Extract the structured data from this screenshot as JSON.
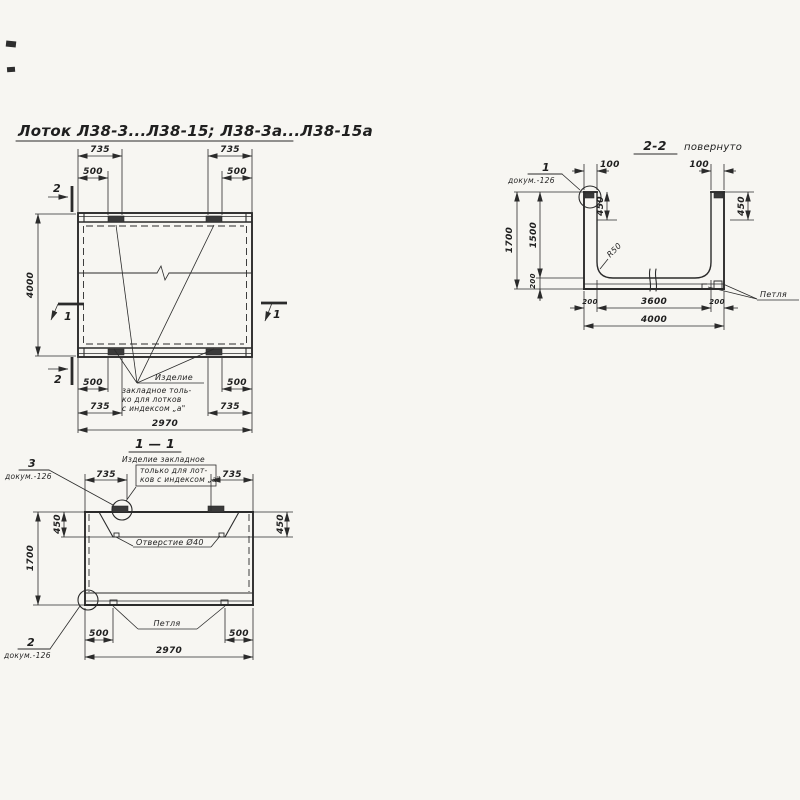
{
  "colors": {
    "ink": "#2b2b2b",
    "paper": "#f7f6f2"
  },
  "title": {
    "text": "Лоток Л38-3...Л38-15; Л38-3а...Л38-15а"
  },
  "plan": {
    "marks": {
      "sec1": "1",
      "sec2": "2"
    },
    "dims": {
      "d735": "735",
      "d500": "500",
      "d4000": "4000",
      "d2970": "2970"
    },
    "note": {
      "line1": "Изделие",
      "line2": "закладное толь-",
      "line3": "ко для лотков",
      "line4": "с индексом „а\""
    }
  },
  "section_1_1": {
    "title": "1 — 1",
    "note": {
      "line1": "Изделие закладное",
      "line2": "только для лот-",
      "line3": "ков с индексом „а\""
    },
    "hole_label": "Отверстие Ø40",
    "loop_label": "Петля",
    "callout_top": {
      "num": "3",
      "doc": "докум.-126"
    },
    "callout_bottom": {
      "num": "2",
      "doc": "докум.-126"
    },
    "dims": {
      "d735": "735",
      "d450": "450",
      "d1700": "1700",
      "d500": "500",
      "d2970": "2970"
    }
  },
  "section_2_2": {
    "title": "2-2",
    "title_note": "повернуто",
    "callout": {
      "num": "1",
      "doc": "докум.-126"
    },
    "loop_label": "Петля",
    "radius_label": "R50",
    "dims": {
      "d100": "100",
      "d450": "450",
      "d1700": "1700",
      "d1500": "1500",
      "d200": "200",
      "d3600": "3600",
      "d4000": "4000"
    }
  }
}
